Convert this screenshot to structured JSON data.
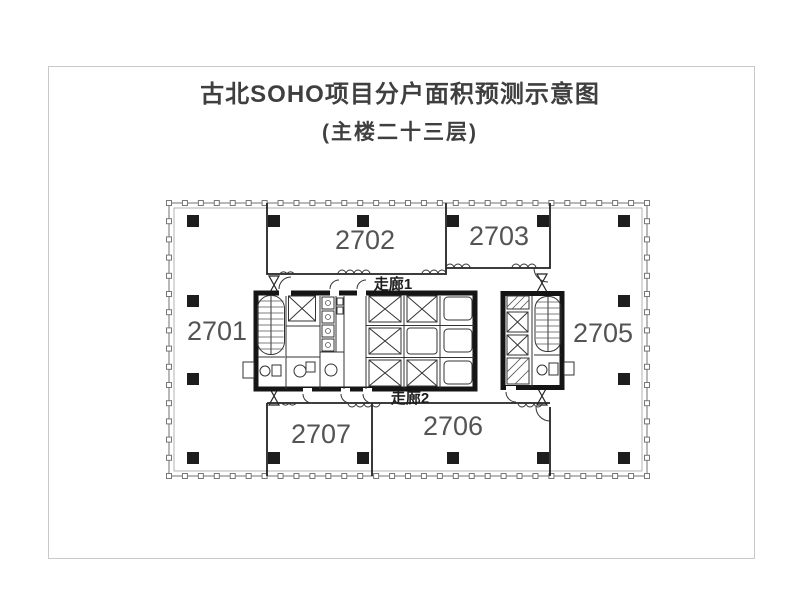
{
  "page": {
    "title": "古北SOHO项目分户面积预测示意图",
    "subtitle": "(主楼二十三层)"
  },
  "floorplan": {
    "room_labels": [
      "2701",
      "2702",
      "2703",
      "2705",
      "2706",
      "2707"
    ],
    "corridor_labels": [
      "走廊1",
      "走廊2"
    ]
  },
  "colors": {
    "wall_line": "#222222",
    "core_wall": "#151515",
    "column_fill": "#1d1d1d",
    "room_label_text": "#545454",
    "title_text": "#3f3f3f",
    "page_frame_border": "#c9c9c9",
    "facade_line": "#8a8a8a"
  }
}
